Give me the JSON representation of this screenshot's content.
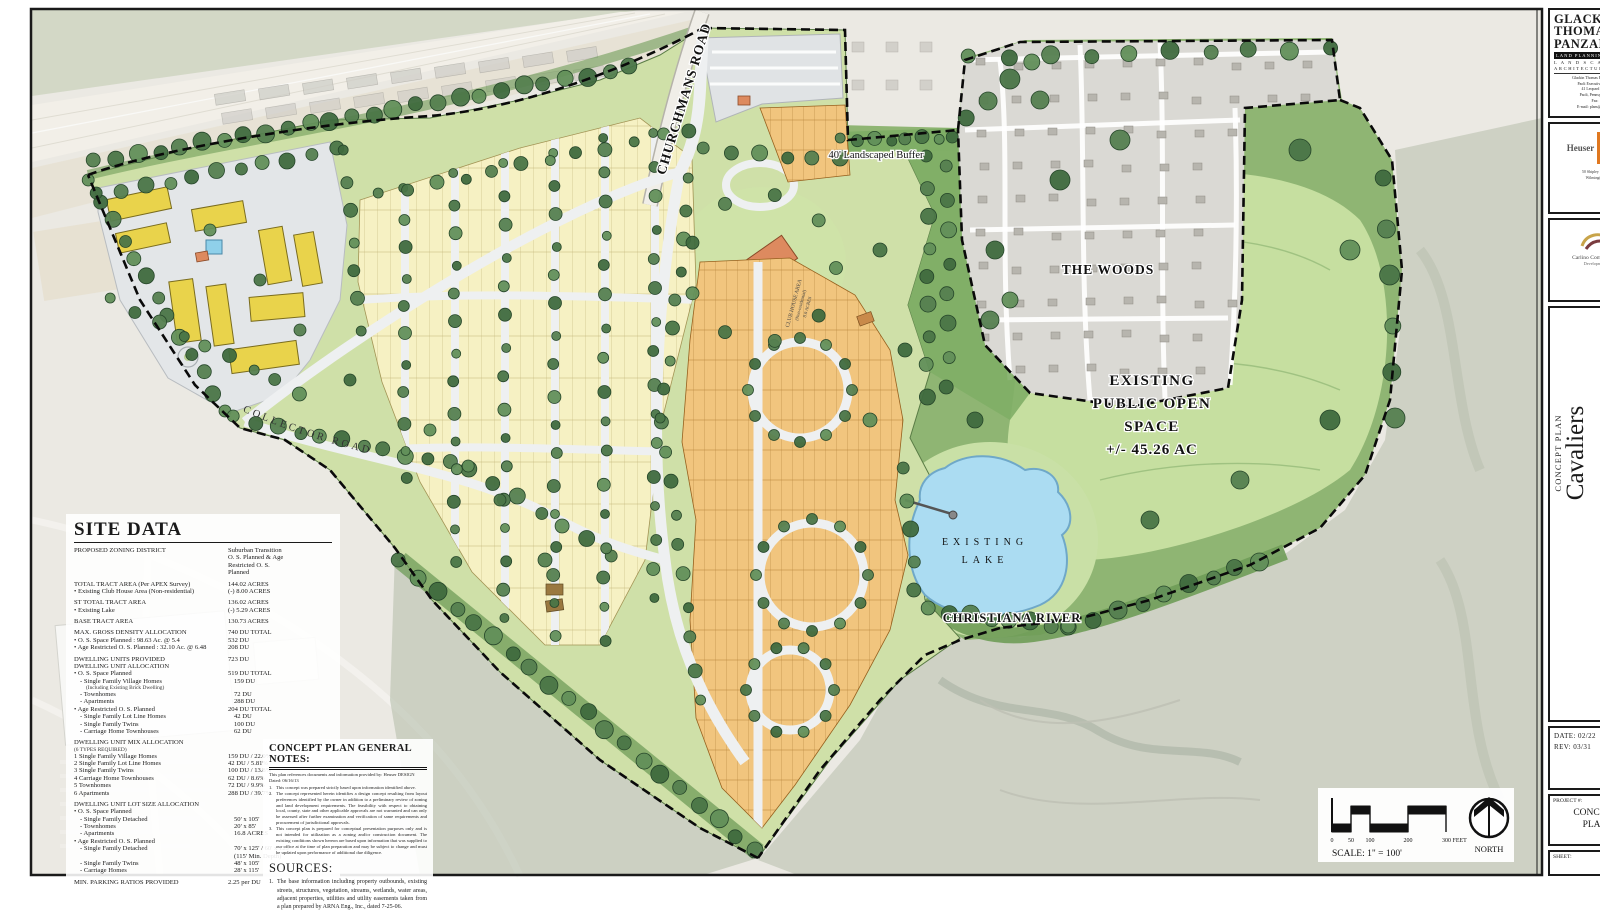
{
  "site_data": {
    "title": "SITE DATA",
    "rows": [
      {
        "l": "PROPOSED ZONING DISTRICT",
        "v": "Suburban Transition\nO. S. Planned & Age\nRestricted O. S.\nPlanned"
      },
      {
        "l": "TOTAL TRACT AREA (Per APEX Survey)",
        "v": "144.02 ACRES",
        "c": "gap"
      },
      {
        "l": "• Existing Club House Area (Non-residential)",
        "v": "(-) 8.00 ACRES"
      },
      {
        "l": "ST TOTAL TRACT AREA",
        "v": "136.02 ACRES",
        "c": "gap"
      },
      {
        "l": "• Existing Lake",
        "v": "(-) 5.29 ACRES"
      },
      {
        "l": "BASE TRACT AREA",
        "v": "130.73 ACRES",
        "c": "gap"
      },
      {
        "l": "MAX. GROSS DENSITY ALLOCATION",
        "v": "740 DU TOTAL",
        "c": "gap"
      },
      {
        "l": "• O. S. Space Planned : 98.63 Ac. @ 5.4",
        "v": "532 DU"
      },
      {
        "l": "• Age Restricted O. S. Planned : 32.10 Ac. @ 6.48",
        "v": "208 DU"
      },
      {
        "l": "DWELLING UNITS PROVIDED",
        "v": "723 DU",
        "c": "gap"
      },
      {
        "l": "DWELLING UNIT ALLOCATION",
        "v": ""
      },
      {
        "l": "• O. S. Space Planned",
        "v": "519 DU TOTAL"
      },
      {
        "l": "- Single Family Village Homes",
        "v": "159 DU",
        "c": "i1"
      },
      {
        "l": "(Including Existing Brick Dwelling)",
        "v": "",
        "c": "i2 tiny"
      },
      {
        "l": "- Townhomes",
        "v": "72 DU",
        "c": "i1"
      },
      {
        "l": "- Apartments",
        "v": "288 DU",
        "c": "i1"
      },
      {
        "l": "• Age Restricted O. S. Planned",
        "v": "204 DU TOTAL"
      },
      {
        "l": "- Single Family Lot Line Homes",
        "v": "42 DU",
        "c": "i1"
      },
      {
        "l": "- Single Family Twins",
        "v": "100 DU",
        "c": "i1"
      },
      {
        "l": "- Carriage Home Townhouses",
        "v": "62 DU",
        "c": "i1"
      },
      {
        "l": "DWELLING UNIT MIX ALLOCATION",
        "v": "",
        "c": "gap"
      },
      {
        "l": "(6 TYPES REQUIRED)",
        "v": "",
        "c": "tiny"
      },
      {
        "l": "1  Single Family Village Homes",
        "v": "159 DU / 22.0%"
      },
      {
        "l": "2  Single Family Lot Line Homes",
        "v": "42 DU / 5.81%"
      },
      {
        "l": "3  Single Family Twins",
        "v": "100 DU / 13.8%"
      },
      {
        "l": "4  Carriage Home Townhouses",
        "v": "62 DU / 8.6%"
      },
      {
        "l": "5  Townhomes",
        "v": "72 DU / 9.9%"
      },
      {
        "l": "6  Apartments",
        "v": "288 DU / 39.7%"
      },
      {
        "l": "DWELLING UNIT LOT SIZE ALLOCATION",
        "v": "",
        "c": "gap"
      },
      {
        "l": "• O. S. Space Planned",
        "v": ""
      },
      {
        "l": "- Single Family Detached",
        "v": "50' x 105'",
        "c": "i1"
      },
      {
        "l": "- Townhomes",
        "v": "20' x 85'",
        "c": "i1"
      },
      {
        "l": "- Apartments",
        "v": "16.8 ACRES",
        "c": "i1"
      },
      {
        "l": "• Age Restricted O. S. Planned",
        "v": ""
      },
      {
        "l": "- Single Family Detached",
        "v": "70' x 125' / 60' x 125'\n(115' Min. Depth)",
        "c": "i1"
      },
      {
        "l": "- Single Family Twins",
        "v": "48' x 105'",
        "c": "i1"
      },
      {
        "l": "- Carriage Homes",
        "v": "28' x 115'",
        "c": "i1"
      },
      {
        "l": "MIN. PARKING RATIOS PROVIDED",
        "v": "2.25 per DU",
        "c": "gap"
      }
    ]
  },
  "notes": {
    "title": "CONCEPT PLAN GENERAL NOTES:",
    "intro": "This plan references documents and information provided by:  Heuser DESIGN   Dated: 06/16/13",
    "items": [
      {
        "n": "1.",
        "t": "This concept was prepared strictly based upon information identified above."
      },
      {
        "n": "2.",
        "t": "The concept represented herein identifies a design concept resulting from layout preferences identified by the owner in addition to a preliminary review of zoning and land development requirements. The feasibility with respect to obtaining local, county, state and other applicable approvals are not warranted and can only be assessed after further examination and verification of same requirements and procurement of jurisdictional approvals."
      },
      {
        "n": "3.",
        "t": "This concept plan is prepared for conceptual presentation purposes only and is not intended for utilization as a zoning and/or construction document. The existing conditions shown hereon are based upon information that was supplied to our office at the time of plan preparation and may be subject to change and must be updated upon performance of additional due diligence."
      }
    ],
    "sources_title": "SOURCES:",
    "sources": [
      {
        "n": "1.",
        "t": "The base information including property outbounds, existing streets, structures, vegetation, streams, wetlands, water areas, adjacent properties, utilities and utility easements taken from a plan prepared by ARNA Eng., Inc., dated 7-25-06."
      }
    ]
  },
  "map": {
    "churchmans_road": "CHURCHMANS ROAD",
    "buffer": "40' Landscaped Buffer",
    "woods": "THE WOODS",
    "open_space": [
      "EXISTING",
      "PUBLIC OPEN",
      "SPACE",
      "+/- 45.26 AC"
    ],
    "lake": [
      "EXISTING",
      "LAKE"
    ],
    "river": "CHRISTIANA RIVER",
    "collector": "COLLECTOR ROAD",
    "club": [
      "CLUB HOUSE AREA",
      "(Non-residential)",
      "8.0 ACRES"
    ]
  },
  "scalebox": {
    "ticks": [
      "0",
      "50",
      "100",
      "200",
      "300 FEET"
    ],
    "scale_label": "SCALE:  1\" = 100'",
    "north_label": "NORTH"
  },
  "tb": {
    "firm_lines": [
      "GLACKIN",
      "THOMAS",
      "PANZAK"
    ],
    "tag1": "LAND PLANNING",
    "tag2": "L A N D S C A P E",
    "tag3": "ARCHITECTURE",
    "addr": [
      "Glackin Thomas Panzak, Inc.",
      "Paoli Executive Green",
      "41 Leopard Road",
      "Paoli, Pennsylvania",
      "Fax:",
      "E-mail: plans@glackin"
    ],
    "logo1_name": "Heuser",
    "logo1_sub": "DESIGN",
    "logo1_addr": [
      "50 Shipley Road",
      "Wilmington"
    ],
    "logo2_name": "Carlino Commercial",
    "logo2_sub": "Development",
    "proj_label": "CONCEPT PLAN",
    "proj_name": "Cavaliers",
    "date_label": "DATE:",
    "date_val": "02/22",
    "rev_label": "REV:",
    "rev_val": "03/31",
    "projnum_label": "PROJECT #:",
    "proj_box": [
      "CONCEPT",
      "PLAN"
    ],
    "sheet_label": "SHEET:"
  }
}
